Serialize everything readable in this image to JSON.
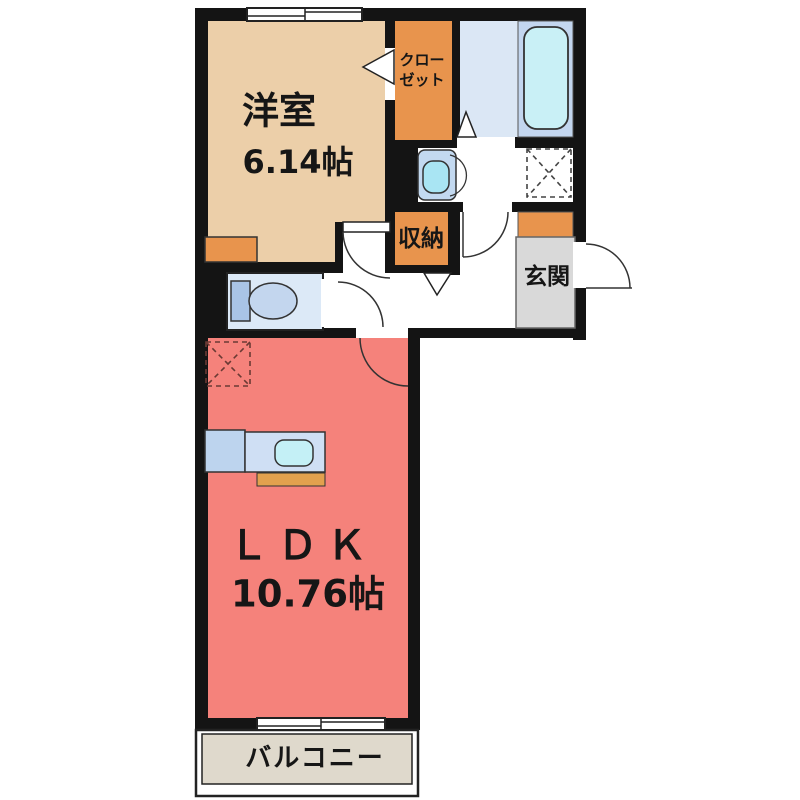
{
  "plan_type": "apartment-floor-plan",
  "rooms": {
    "western_room": {
      "name": "洋室",
      "area": "6.14帖"
    },
    "closet": {
      "name_line1": "クロー",
      "name_line2": "ゼット"
    },
    "storage": {
      "name": "収納"
    },
    "entrance": {
      "name": "玄関"
    },
    "ldk": {
      "name": "ＬＤＫ",
      "area": "10.76帖"
    },
    "balcony": {
      "name": "バルコニー"
    },
    "bathroom": {
      "name": ""
    },
    "washroom": {
      "name": ""
    },
    "toilet_room": {
      "name": ""
    }
  },
  "fixtures": [
    "bathtub",
    "toilet",
    "washbasin",
    "kitchen-counter",
    "kitchen-sink",
    "washing-machine-space",
    "refrigerator-space",
    "shoe-cabinet",
    "western-room-cabinet",
    "sliding-window",
    "balcony-sliding-door",
    "entrance-door",
    "hinged-doors",
    "folding-doors"
  ],
  "colors": {
    "wall": "#141414",
    "western_room": "#eccfa9",
    "accent_orange": "#e8944d",
    "kitchen_bar_orange": "#e2a14e",
    "ldk_pink": "#f5827b",
    "entrance_gray": "#d9d9d9",
    "balcony_beige": "#dfd9cc",
    "bath_floor": "#dbe7f5",
    "tub_panel": "#c3d6ef",
    "tub_fill": "#c9f0f6",
    "toilet_floor": "#dce9f7",
    "toilet_tank": "#a9c4e6",
    "toilet_bowl": "#c3d6ee",
    "basin_body": "#c3d9f0",
    "basin_bowl": "#a9e5f3",
    "kitchen_left": "#bdd4ee",
    "kitchen_right": "#cfdff4",
    "sink_fill": "#c4f0f6",
    "white": "#ffffff",
    "dash_dark": "#444444",
    "dash_red": "#6b3a34"
  }
}
